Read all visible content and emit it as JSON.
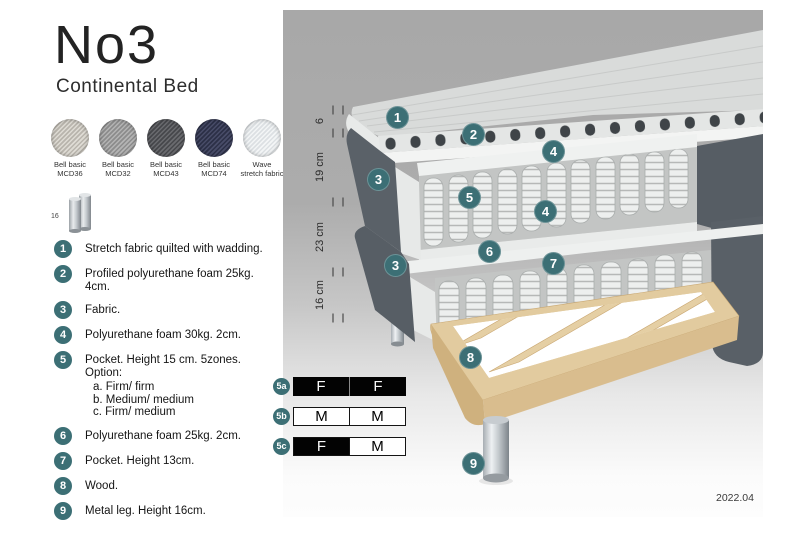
{
  "header": {
    "title": "No3",
    "subtitle": "Continental Bed"
  },
  "swatches": [
    {
      "line1": "Bell basic",
      "line2": "MCD36",
      "color": "#cfccc5"
    },
    {
      "line1": "Bell basic",
      "line2": "MCD32",
      "color": "#a3a3a3"
    },
    {
      "line1": "Bell basic",
      "line2": "MCD43",
      "color": "#57585c"
    },
    {
      "line1": "Bell basic",
      "line2": "MCD74",
      "color": "#383c55"
    },
    {
      "line1": "Wave",
      "line2": "stretch fabric",
      "color": "#e9ebed"
    }
  ],
  "leg_icon": {
    "label": "16"
  },
  "parts": [
    {
      "num": "1",
      "text": "Stretch fabric quilted with wadding."
    },
    {
      "num": "2",
      "text": "Profiled polyurethane foam 25kg. 4cm."
    },
    {
      "num": "3",
      "text": "Fabric."
    },
    {
      "num": "4",
      "text": "Polyurethane foam 30kg. 2cm."
    },
    {
      "num": "5",
      "text": "Pocket. Height 15 cm. 5zones. Option:",
      "options": [
        "a. Firm/ firm",
        "b. Medium/ medium",
        "c. Firm/ medium"
      ]
    },
    {
      "num": "6",
      "text": "Polyurethane foam 25kg. 2cm."
    },
    {
      "num": "7",
      "text": "Pocket. Height 13cm."
    },
    {
      "num": "8",
      "text": "Wood."
    },
    {
      "num": "9",
      "text": "Metal leg. Height 16cm."
    }
  ],
  "diagram": {
    "dimensions": [
      {
        "label": "6"
      },
      {
        "label": "19 cm"
      },
      {
        "label": "23 cm"
      },
      {
        "label": "16 cm"
      }
    ],
    "callouts": [
      {
        "num": "1"
      },
      {
        "num": "2"
      },
      {
        "num": "4"
      },
      {
        "num": "3"
      },
      {
        "num": "5"
      },
      {
        "num": "4"
      },
      {
        "num": "6"
      },
      {
        "num": "7"
      },
      {
        "num": "3"
      },
      {
        "num": "8"
      },
      {
        "num": "9"
      }
    ],
    "date": "2022.04",
    "badge_color": "#3c6f75",
    "fabric_color": "#5a6168",
    "wood_color": "#e2cb9f",
    "metal_color": "#c7ccd0"
  },
  "firmness": {
    "rows": [
      {
        "label": "5a",
        "cells": [
          {
            "text": "F",
            "fill": "black"
          },
          {
            "text": "F",
            "fill": "black"
          }
        ]
      },
      {
        "label": "5b",
        "cells": [
          {
            "text": "M",
            "fill": "white"
          },
          {
            "text": "M",
            "fill": "white"
          }
        ]
      },
      {
        "label": "5c",
        "cells": [
          {
            "text": "F",
            "fill": "black"
          },
          {
            "text": "M",
            "fill": "white"
          }
        ]
      }
    ]
  }
}
